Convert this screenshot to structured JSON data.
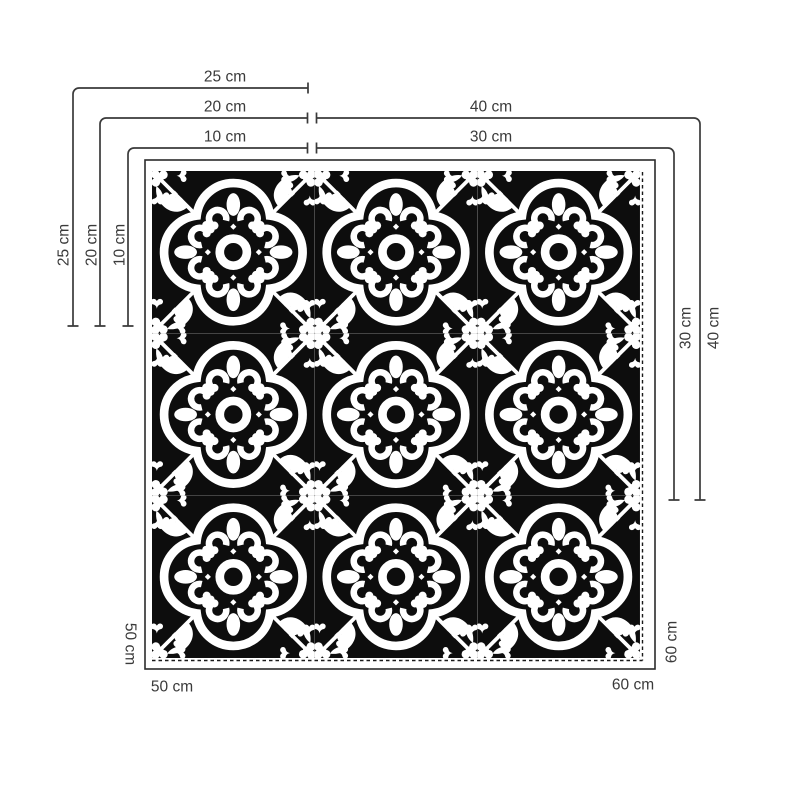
{
  "diagram": {
    "title": "Tile size options diagram",
    "sizes": {
      "s10": "10 cm",
      "s20": "20 cm",
      "s25": "25 cm",
      "s30": "30 cm",
      "s40": "40 cm",
      "s50": "50 cm",
      "s60": "60 cm"
    },
    "tile": {
      "rows": 3,
      "cols": 3,
      "style": "quatrefoil-encaustic"
    },
    "colors": {
      "line": "#3a3a3a",
      "text": "#3a3a3a",
      "frame": "#2b2b2b",
      "tile_bg": "#0d0d0d",
      "tile_fg": "#ffffff",
      "page_bg": "#ffffff"
    }
  }
}
